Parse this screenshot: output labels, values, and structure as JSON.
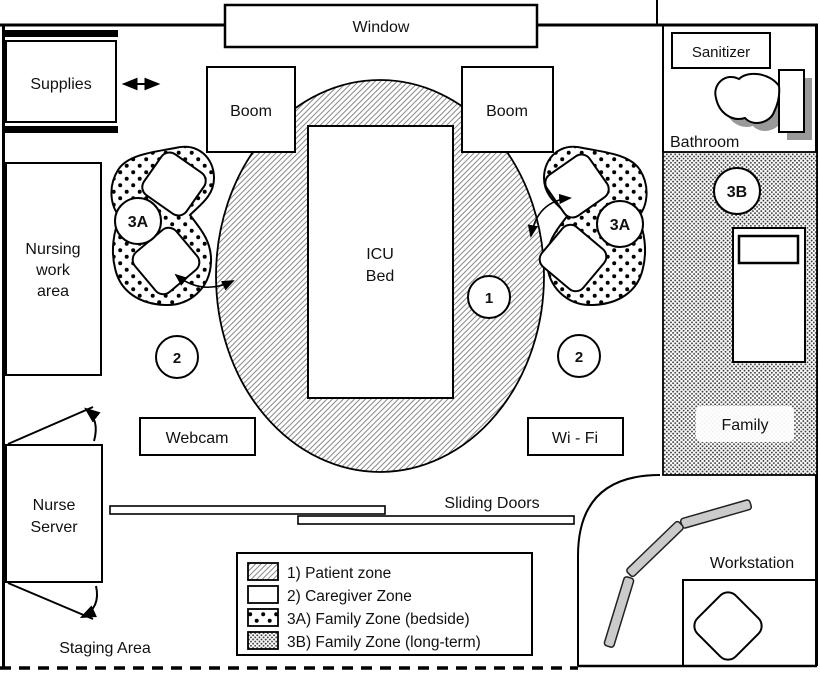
{
  "rooms": {
    "window": "Window",
    "supplies": "Supplies",
    "boom_left": "Boom",
    "boom_right": "Boom",
    "icu_bed": {
      "line1": "ICU",
      "line2": "Bed"
    },
    "nursing_work_area": {
      "line1": "Nursing",
      "line2": "work",
      "line3": "area"
    },
    "webcam": "Webcam",
    "wifi": "Wi - Fi",
    "nurse_server": {
      "line1": "Nurse",
      "line2": "Server"
    },
    "staging_area": "Staging Area",
    "sliding_doors": "Sliding Doors",
    "sanitizer": "Sanitizer",
    "bathroom": "Bathroom",
    "family": "Family",
    "workstation": "Workstation"
  },
  "zone_markers": {
    "patient": "1",
    "caregiver_left": "2",
    "caregiver_right": "2",
    "family_bedside_left": "3A",
    "family_bedside_right": "3A",
    "family_longterm": "3B"
  },
  "legend": {
    "items": [
      {
        "swatch": "hatch-diagonal",
        "label": "1) Patient zone"
      },
      {
        "swatch": "plain-white",
        "label": "2) Caregiver Zone"
      },
      {
        "swatch": "dots-sparse",
        "label": "3A) Family Zone (bedside)"
      },
      {
        "swatch": "dots-dense",
        "label": "3B) Family Zone (long-term)"
      }
    ]
  },
  "colors": {
    "line": "#000000",
    "background": "#ffffff",
    "shadow_gray": "#999999",
    "segment_gray": "#cbcbcb"
  }
}
